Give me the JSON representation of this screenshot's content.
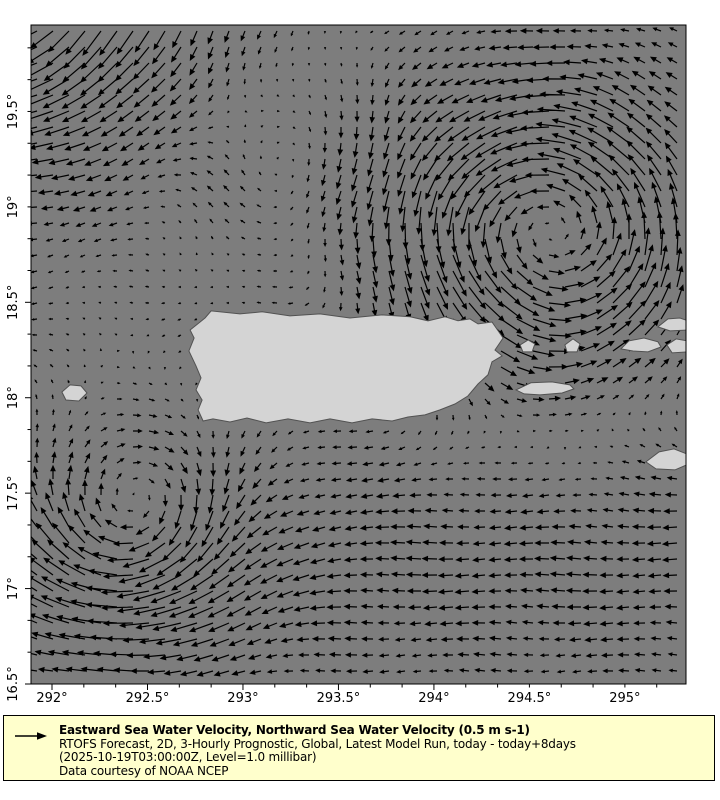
{
  "colors": {
    "sea": "#7d7d7d",
    "land_fill": "#d4d4d4",
    "land_edge": "#525252",
    "arrow": "#000000",
    "axis": "#000000",
    "legend_bg": "#ffffcc",
    "page_bg": "#ffffff"
  },
  "chart_data": {
    "type": "quiver",
    "title": "Eastward Sea Water Velocity, Northward Sea Water Velocity (0.5 m s-1)",
    "subtitle1": "RTOFS Forecast, 2D, 3-Hourly Prognostic, Global, Latest Model Run, today - today+8days",
    "subtitle2": "(2025-10-19T03:00:00Z, Level=1.0 millibar)",
    "credit": "Data courtesy of NOAA NCEP",
    "reference_vector_ms": 0.5,
    "xlim": [
      291.89,
      295.32
    ],
    "ylim": [
      16.5,
      19.953
    ],
    "x_tick_values": [
      292,
      292.5,
      293,
      293.5,
      294,
      294.5,
      295
    ],
    "xlabel_ticks": [
      "292°",
      "292.5°",
      "293°",
      "293.5°",
      "294°",
      "294.5°",
      "295°"
    ],
    "y_tick_values": [
      16.5,
      17,
      17.5,
      18,
      18.5,
      19,
      19.5
    ],
    "ylabel_ticks": [
      "16.5°",
      "17°",
      "17.5°",
      "18°",
      "18.5°",
      "19°",
      "19.5°"
    ],
    "minor_tick_step_deg": 0.1666667,
    "grid_step_deg": 0.0838,
    "flow_model": {
      "base_u": -0.06,
      "base_v": 0.0,
      "caribbean_jet": {
        "u_amp": -0.26,
        "lat_center": 17.15,
        "lat_width": 0.8
      },
      "north_coast_jet": {
        "u_amp": 0.22,
        "lat_center": 18.78,
        "lat_width": 0.28,
        "lon_center": 293.7,
        "lon_width": 1.1
      },
      "eddies": [
        {
          "lon": 294.62,
          "lat": 18.85,
          "strength": 0.52,
          "radius": 0.7
        },
        {
          "lon": 292.42,
          "lat": 17.3,
          "strength": -0.38,
          "radius": 0.55
        },
        {
          "lon": 291.7,
          "lat": 20.3,
          "strength": -0.55,
          "radius": 0.9
        },
        {
          "lon": 293.3,
          "lat": 19.15,
          "strength": -0.15,
          "radius": 0.5
        }
      ],
      "ripple_u_amp": 0.03,
      "ripple_v_amp": 0.03
    },
    "islands": {
      "puerto_rico": [
        [
          292.801,
          18.418
        ],
        [
          292.833,
          18.455
        ],
        [
          292.984,
          18.439
        ],
        [
          293.1,
          18.45
        ],
        [
          293.246,
          18.429
        ],
        [
          293.403,
          18.439
        ],
        [
          293.56,
          18.418
        ],
        [
          293.728,
          18.434
        ],
        [
          293.875,
          18.424
        ],
        [
          293.969,
          18.403
        ],
        [
          294.058,
          18.424
        ],
        [
          294.126,
          18.403
        ],
        [
          294.189,
          18.413
        ],
        [
          294.231,
          18.387
        ],
        [
          294.304,
          18.397
        ],
        [
          294.362,
          18.313
        ],
        [
          294.32,
          18.25
        ],
        [
          294.357,
          18.219
        ],
        [
          294.304,
          18.188
        ],
        [
          294.283,
          18.12
        ],
        [
          294.231,
          18.072
        ],
        [
          294.178,
          18.009
        ],
        [
          294.11,
          17.967
        ],
        [
          294.032,
          17.936
        ],
        [
          293.953,
          17.91
        ],
        [
          293.864,
          17.899
        ],
        [
          293.781,
          17.878
        ],
        [
          293.676,
          17.889
        ],
        [
          293.571,
          17.868
        ],
        [
          293.456,
          17.889
        ],
        [
          293.351,
          17.868
        ],
        [
          293.236,
          17.889
        ],
        [
          293.121,
          17.868
        ],
        [
          293.021,
          17.894
        ],
        [
          292.932,
          17.873
        ],
        [
          292.843,
          17.889
        ],
        [
          292.791,
          17.878
        ],
        [
          292.765,
          17.936
        ],
        [
          292.786,
          17.988
        ],
        [
          292.754,
          18.041
        ],
        [
          292.78,
          18.104
        ],
        [
          292.754,
          18.167
        ],
        [
          292.717,
          18.245
        ],
        [
          292.744,
          18.313
        ],
        [
          292.723,
          18.355
        ],
        [
          292.77,
          18.392
        ]
      ],
      "mona": [
        [
          292.052,
          18.03
        ],
        [
          292.094,
          18.067
        ],
        [
          292.152,
          18.062
        ],
        [
          292.183,
          18.025
        ],
        [
          292.141,
          17.983
        ],
        [
          292.073,
          17.988
        ]
      ],
      "vieques": [
        [
          294.43,
          18.041
        ],
        [
          294.508,
          18.078
        ],
        [
          294.618,
          18.083
        ],
        [
          294.712,
          18.067
        ],
        [
          294.733,
          18.046
        ],
        [
          294.671,
          18.025
        ],
        [
          294.555,
          18.015
        ],
        [
          294.472,
          18.02
        ]
      ],
      "islet_east_pr": [
        [
          294.451,
          18.277
        ],
        [
          294.493,
          18.303
        ],
        [
          294.529,
          18.282
        ],
        [
          294.514,
          18.24
        ],
        [
          294.466,
          18.24
        ]
      ],
      "culebra": [
        [
          294.686,
          18.277
        ],
        [
          294.728,
          18.308
        ],
        [
          294.765,
          18.282
        ],
        [
          294.749,
          18.24
        ],
        [
          294.697,
          18.24
        ]
      ],
      "st_thomas": [
        [
          294.979,
          18.256
        ],
        [
          295.021,
          18.298
        ],
        [
          295.1,
          18.313
        ],
        [
          295.173,
          18.293
        ],
        [
          295.189,
          18.266
        ],
        [
          295.121,
          18.24
        ],
        [
          295.043,
          18.245
        ]
      ],
      "east_isle": [
        [
          295.22,
          18.277
        ],
        [
          295.268,
          18.308
        ],
        [
          295.33,
          18.298
        ],
        [
          295.33,
          18.24
        ],
        [
          295.247,
          18.235
        ]
      ],
      "top_right_isle": [
        [
          295.173,
          18.371
        ],
        [
          295.226,
          18.413
        ],
        [
          295.288,
          18.418
        ],
        [
          295.33,
          18.403
        ],
        [
          295.33,
          18.355
        ],
        [
          295.236,
          18.35
        ]
      ],
      "st_croix": [
        [
          295.11,
          17.664
        ],
        [
          295.179,
          17.716
        ],
        [
          295.257,
          17.732
        ],
        [
          295.325,
          17.705
        ],
        [
          295.335,
          17.653
        ],
        [
          295.262,
          17.622
        ],
        [
          295.163,
          17.627
        ]
      ]
    }
  }
}
